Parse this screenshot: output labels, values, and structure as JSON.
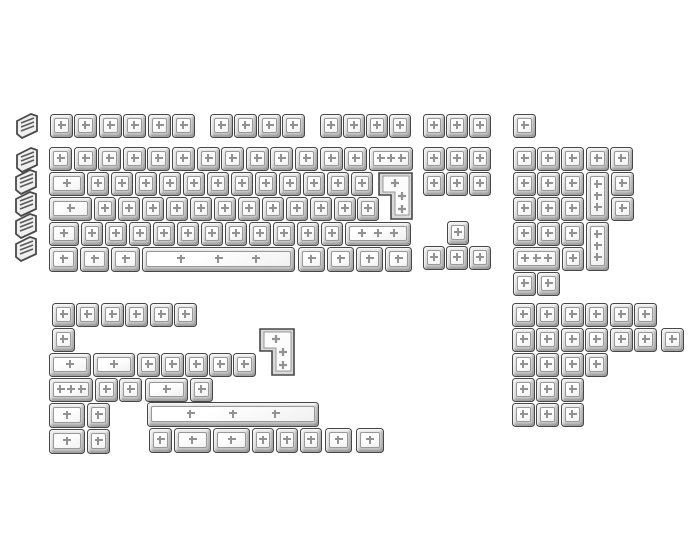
{
  "image": {
    "width": 700,
    "height": 560,
    "background": "#ffffff",
    "content": "product render of a full transparent blank keycap set, no text"
  },
  "colors": {
    "key_outline": "#474747",
    "key_bevel_light": "#e9e9e9",
    "key_bevel_dark": "#c9c9c9",
    "key_face": "#ffffff",
    "face_outline": "#989898",
    "stem_cross": "#929292",
    "side_cap_outline": "#4a4a4a",
    "side_cap_fill": "#efefef"
  },
  "keycap_set": {
    "style": "clear-transparent-blank",
    "keycap_count": 174,
    "key_format": "[x,y,w,h,stem_crosses,shape?] px; shape: v=vertical tall key, iso=ISO-enter shape",
    "sections": [
      {
        "name": "side-profile-column",
        "caps": [
          [
            14,
            112
          ],
          [
            14,
            146
          ],
          [
            13,
            168
          ],
          [
            13,
            190
          ],
          [
            13,
            212
          ],
          [
            13,
            235
          ]
        ]
      },
      {
        "name": "main-cluster",
        "keys": [
          [
            50,
            114,
            23,
            24,
            1
          ],
          [
            74,
            114,
            23,
            24,
            1
          ],
          [
            99,
            114,
            23,
            24,
            1
          ],
          [
            123,
            114,
            23,
            24,
            1
          ],
          [
            148,
            114,
            23,
            24,
            1
          ],
          [
            172,
            114,
            23,
            24,
            1
          ],
          [
            210,
            114,
            23,
            24,
            1
          ],
          [
            234,
            114,
            23,
            24,
            1
          ],
          [
            258,
            114,
            23,
            24,
            1
          ],
          [
            282,
            114,
            23,
            24,
            1
          ],
          [
            320,
            114,
            22,
            24,
            1
          ],
          [
            343,
            114,
            22,
            24,
            1
          ],
          [
            366,
            114,
            22,
            24,
            1
          ],
          [
            389,
            114,
            22,
            24,
            1
          ],
          [
            49,
            147,
            23,
            24,
            1
          ],
          [
            74,
            147,
            23,
            24,
            1
          ],
          [
            98,
            147,
            23,
            24,
            1
          ],
          [
            123,
            147,
            23,
            24,
            1
          ],
          [
            147,
            147,
            23,
            24,
            1
          ],
          [
            172,
            147,
            23,
            24,
            1
          ],
          [
            197,
            147,
            23,
            24,
            1
          ],
          [
            221,
            147,
            23,
            24,
            1
          ],
          [
            246,
            147,
            23,
            24,
            1
          ],
          [
            270,
            147,
            23,
            24,
            1
          ],
          [
            295,
            147,
            23,
            24,
            1
          ],
          [
            320,
            147,
            23,
            24,
            1
          ],
          [
            344,
            147,
            23,
            24,
            1
          ],
          [
            369,
            147,
            44,
            24,
            3
          ],
          [
            49,
            172,
            36,
            24,
            1
          ],
          [
            87,
            172,
            22,
            24,
            1
          ],
          [
            111,
            172,
            22,
            24,
            1
          ],
          [
            135,
            172,
            22,
            24,
            1
          ],
          [
            159,
            172,
            22,
            24,
            1
          ],
          [
            183,
            172,
            22,
            24,
            1
          ],
          [
            207,
            172,
            22,
            24,
            1
          ],
          [
            231,
            172,
            22,
            24,
            1
          ],
          [
            255,
            172,
            22,
            24,
            1
          ],
          [
            279,
            172,
            22,
            24,
            1
          ],
          [
            303,
            172,
            22,
            24,
            1
          ],
          [
            327,
            172,
            22,
            24,
            1
          ],
          [
            351,
            172,
            22,
            24,
            1
          ],
          [
            378,
            172,
            35,
            48,
            3,
            "iso"
          ],
          [
            49,
            197,
            43,
            24,
            1
          ],
          [
            94,
            197,
            22,
            24,
            1
          ],
          [
            118,
            197,
            22,
            24,
            1
          ],
          [
            142,
            197,
            22,
            24,
            1
          ],
          [
            166,
            197,
            22,
            24,
            1
          ],
          [
            190,
            197,
            22,
            24,
            1
          ],
          [
            214,
            197,
            22,
            24,
            1
          ],
          [
            238,
            197,
            22,
            24,
            1
          ],
          [
            262,
            197,
            22,
            24,
            1
          ],
          [
            286,
            197,
            22,
            24,
            1
          ],
          [
            310,
            197,
            22,
            24,
            1
          ],
          [
            334,
            197,
            22,
            24,
            1
          ],
          [
            357,
            197,
            22,
            24,
            1
          ],
          [
            49,
            222,
            30,
            24,
            1
          ],
          [
            81,
            222,
            22,
            24,
            1
          ],
          [
            105,
            222,
            22,
            24,
            1
          ],
          [
            129,
            222,
            22,
            24,
            1
          ],
          [
            153,
            222,
            22,
            24,
            1
          ],
          [
            177,
            222,
            22,
            24,
            1
          ],
          [
            201,
            222,
            22,
            24,
            1
          ],
          [
            225,
            222,
            22,
            24,
            1
          ],
          [
            249,
            222,
            22,
            24,
            1
          ],
          [
            273,
            222,
            22,
            24,
            1
          ],
          [
            297,
            222,
            22,
            24,
            1
          ],
          [
            321,
            222,
            22,
            24,
            1
          ],
          [
            345,
            222,
            66,
            24,
            3
          ],
          [
            49,
            247,
            29,
            25,
            1
          ],
          [
            80,
            247,
            29,
            25,
            1
          ],
          [
            111,
            247,
            29,
            25,
            1
          ],
          [
            142,
            247,
            153,
            25,
            3
          ],
          [
            298,
            247,
            27,
            25,
            1
          ],
          [
            327,
            247,
            27,
            25,
            1
          ],
          [
            356,
            247,
            27,
            25,
            1
          ],
          [
            385,
            247,
            27,
            25,
            1
          ]
        ]
      },
      {
        "name": "nav-cluster",
        "keys": [
          [
            423,
            114,
            22,
            24,
            1
          ],
          [
            446,
            114,
            22,
            24,
            1
          ],
          [
            469,
            114,
            22,
            24,
            1
          ],
          [
            423,
            147,
            22,
            24,
            1
          ],
          [
            446,
            147,
            22,
            24,
            1
          ],
          [
            469,
            147,
            22,
            24,
            1
          ],
          [
            423,
            172,
            22,
            24,
            1
          ],
          [
            446,
            172,
            22,
            24,
            1
          ],
          [
            469,
            172,
            22,
            24,
            1
          ],
          [
            447,
            221,
            22,
            24,
            1
          ],
          [
            423,
            246,
            22,
            24,
            1
          ],
          [
            446,
            246,
            22,
            24,
            1
          ],
          [
            469,
            246,
            22,
            24,
            1
          ]
        ]
      },
      {
        "name": "numpad-cluster",
        "keys": [
          [
            513,
            114,
            23,
            24,
            1
          ],
          [
            513,
            147,
            23,
            24,
            1
          ],
          [
            537,
            147,
            23,
            24,
            1
          ],
          [
            561,
            147,
            23,
            24,
            1
          ],
          [
            586,
            147,
            23,
            24,
            1
          ],
          [
            610,
            147,
            23,
            24,
            1
          ],
          [
            513,
            172,
            23,
            24,
            1
          ],
          [
            537,
            172,
            23,
            24,
            1
          ],
          [
            561,
            172,
            23,
            24,
            1
          ],
          [
            586,
            172,
            23,
            49,
            3,
            "v"
          ],
          [
            611,
            172,
            23,
            24,
            1
          ],
          [
            513,
            197,
            23,
            24,
            1
          ],
          [
            537,
            197,
            23,
            24,
            1
          ],
          [
            561,
            197,
            23,
            24,
            1
          ],
          [
            611,
            197,
            23,
            24,
            1
          ],
          [
            513,
            222,
            23,
            24,
            1
          ],
          [
            537,
            222,
            23,
            24,
            1
          ],
          [
            561,
            222,
            23,
            24,
            1
          ],
          [
            586,
            222,
            23,
            49,
            3,
            "v"
          ],
          [
            513,
            247,
            47,
            24,
            3
          ],
          [
            562,
            247,
            22,
            24,
            1
          ],
          [
            513,
            272,
            23,
            24,
            1
          ],
          [
            537,
            272,
            23,
            24,
            1
          ]
        ]
      },
      {
        "name": "extras-bottom-left",
        "keys": [
          [
            52,
            303,
            23,
            24,
            1
          ],
          [
            76,
            303,
            23,
            24,
            1
          ],
          [
            101,
            303,
            23,
            24,
            1
          ],
          [
            125,
            303,
            23,
            24,
            1
          ],
          [
            150,
            303,
            23,
            24,
            1
          ],
          [
            174,
            303,
            23,
            24,
            1
          ],
          [
            52,
            328,
            23,
            24,
            1
          ],
          [
            259,
            328,
            36,
            48,
            3,
            "iso"
          ],
          [
            49,
            353,
            42,
            24,
            1
          ],
          [
            93,
            353,
            42,
            24,
            1
          ],
          [
            137,
            353,
            23,
            24,
            1
          ],
          [
            161,
            353,
            23,
            24,
            1
          ],
          [
            185,
            353,
            23,
            24,
            1
          ],
          [
            209,
            353,
            23,
            24,
            1
          ],
          [
            233,
            353,
            23,
            24,
            1
          ],
          [
            49,
            378,
            44,
            24,
            3
          ],
          [
            95,
            378,
            23,
            24,
            1
          ],
          [
            119,
            378,
            23,
            24,
            1
          ],
          [
            145,
            378,
            43,
            24,
            1
          ],
          [
            190,
            378,
            23,
            24,
            1
          ],
          [
            49,
            403,
            36,
            25,
            1
          ],
          [
            87,
            403,
            23,
            25,
            1
          ],
          [
            147,
            402,
            172,
            25,
            3
          ],
          [
            49,
            429,
            36,
            25,
            1
          ],
          [
            87,
            429,
            23,
            25,
            1
          ],
          [
            149,
            428,
            23,
            25,
            1
          ],
          [
            174,
            428,
            37,
            25,
            1
          ],
          [
            213,
            428,
            37,
            25,
            1
          ],
          [
            252,
            428,
            22,
            25,
            1
          ],
          [
            276,
            428,
            22,
            25,
            1
          ],
          [
            300,
            428,
            22,
            25,
            1
          ],
          [
            325,
            428,
            27,
            25,
            1
          ],
          [
            356,
            428,
            28,
            25,
            1
          ]
        ]
      },
      {
        "name": "extras-bottom-right",
        "keys": [
          [
            512,
            303,
            23,
            24,
            1
          ],
          [
            536,
            303,
            23,
            24,
            1
          ],
          [
            561,
            303,
            23,
            24,
            1
          ],
          [
            585,
            303,
            23,
            24,
            1
          ],
          [
            610,
            303,
            23,
            24,
            1
          ],
          [
            634,
            303,
            23,
            24,
            1
          ],
          [
            512,
            328,
            23,
            24,
            1
          ],
          [
            536,
            328,
            23,
            24,
            1
          ],
          [
            561,
            328,
            23,
            24,
            1
          ],
          [
            585,
            328,
            23,
            24,
            1
          ],
          [
            610,
            328,
            23,
            24,
            1
          ],
          [
            634,
            328,
            23,
            24,
            1
          ],
          [
            661,
            328,
            23,
            24,
            1
          ],
          [
            512,
            353,
            23,
            24,
            1
          ],
          [
            536,
            353,
            23,
            24,
            1
          ],
          [
            561,
            353,
            23,
            24,
            1
          ],
          [
            585,
            353,
            23,
            24,
            1
          ],
          [
            512,
            378,
            23,
            24,
            1
          ],
          [
            536,
            378,
            23,
            24,
            1
          ],
          [
            561,
            378,
            23,
            24,
            1
          ],
          [
            512,
            403,
            23,
            24,
            1
          ],
          [
            536,
            403,
            23,
            24,
            1
          ],
          [
            561,
            403,
            23,
            24,
            1
          ]
        ]
      }
    ]
  }
}
